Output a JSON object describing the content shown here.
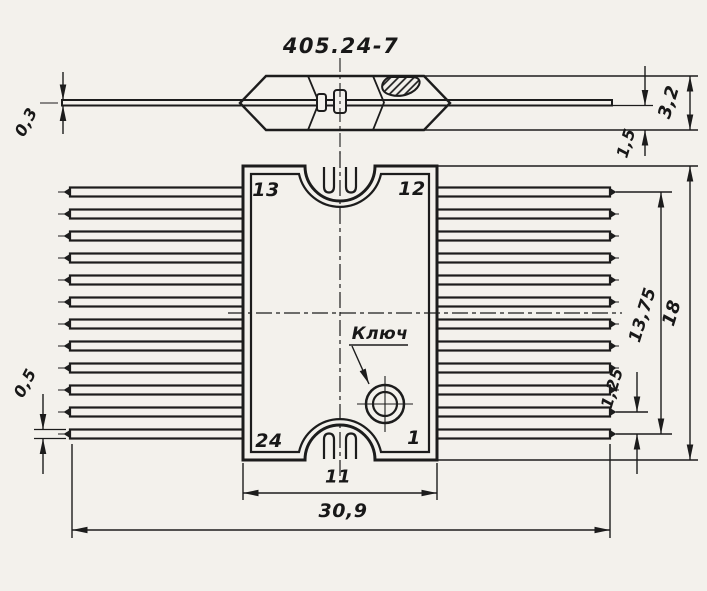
{
  "drawing": {
    "title": "405.24-7",
    "key_label": "Ключ",
    "pins": {
      "top_left": "13",
      "top_right": "12",
      "bottom_left": "24",
      "bottom_right": "1"
    },
    "dims": {
      "lead_thickness": "0,3",
      "body_profile_height": "3,2",
      "lead_plane_offset": "1,5",
      "lead_width": "0,5",
      "body_width": "11",
      "overall_width": "30,9",
      "pin_pitch": "1,25",
      "pin_row_span": "13,75",
      "body_length": "18"
    },
    "ink_color": "#1c1c1c",
    "paper_color": "#f3f1ec"
  }
}
